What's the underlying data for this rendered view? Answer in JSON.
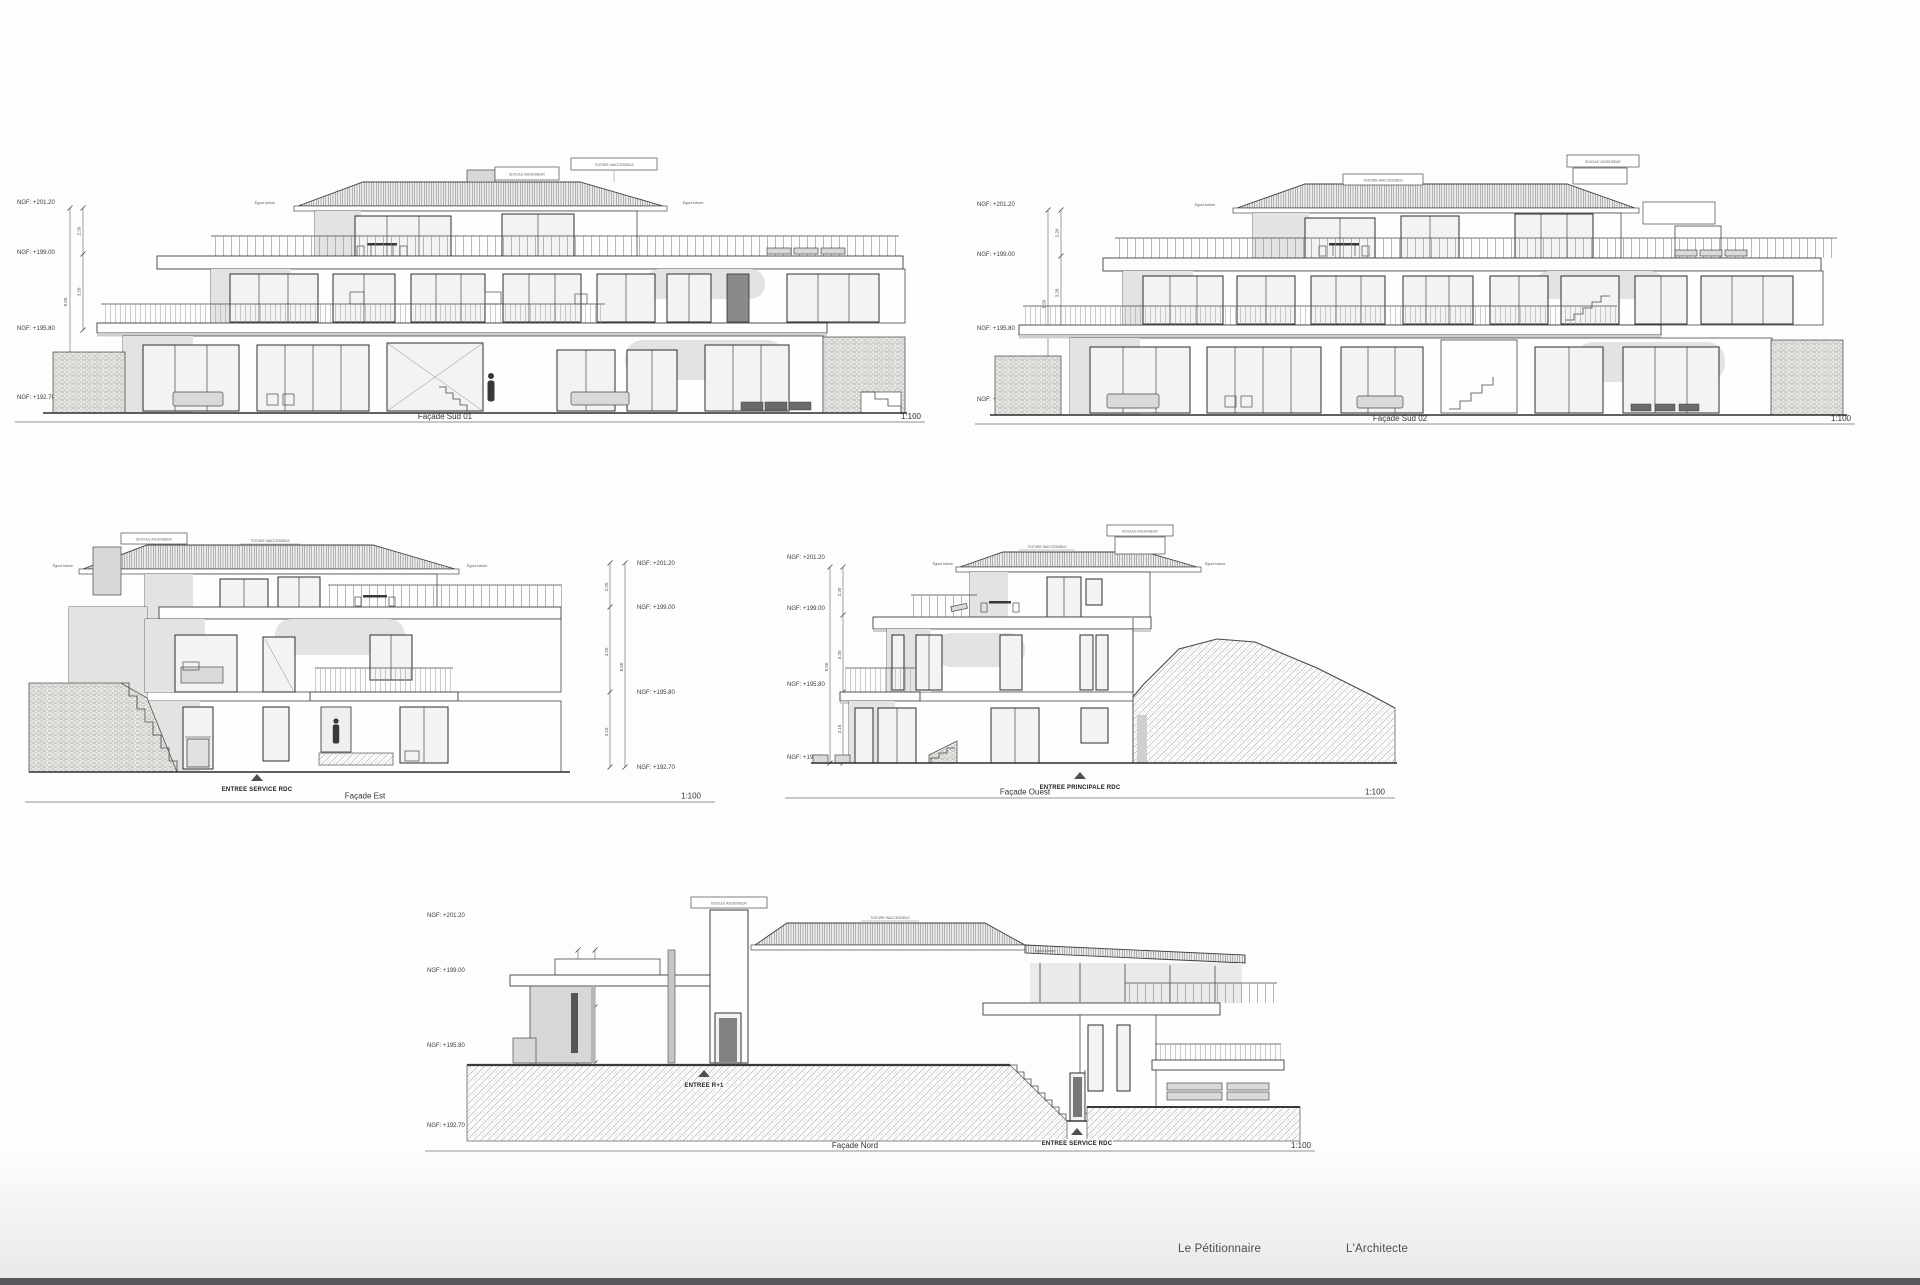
{
  "page": {
    "background": "#fdfdfd",
    "bottom_bar_color": "#56575a"
  },
  "common": {
    "scale_label": "1:100",
    "ngf": [
      "NGF: +201.20",
      "NGF: +199.00",
      "NGF: +195.80",
      "NGF: +192.70"
    ],
    "dims": {
      "d220": "2.20",
      "d320": "3.20",
      "d310": "3.10",
      "d850": "8.50",
      "d345": "3.45"
    },
    "annotations": {
      "edicule": "EDICULE ASCENSEUR",
      "toiture": "TOITURE INACCESSIBLE",
      "egout": "Égout toiture"
    },
    "entries": {
      "service": "ENTREE SERVICE RDC",
      "principale": "ENTREE PRINCIPALE RDC",
      "r1": "ENTREE R+1"
    }
  },
  "drawings": {
    "sud01": {
      "title": "Façade Sud 01"
    },
    "sud02": {
      "title": "Façade Sud 02"
    },
    "est": {
      "title": "Façade Est"
    },
    "ouest": {
      "title": "Façade Ouest"
    },
    "nord": {
      "title": "Façade Nord"
    }
  },
  "footer": {
    "petitionnaire": "Le Pétitionnaire",
    "architecte": "L'Architecte"
  },
  "colors": {
    "line": "#3f3f3f",
    "wall_shade": "#e3e3e2",
    "slab_shadow": "#a9a9a8",
    "window_frame": "#2d2d2d",
    "stone_joint": "#9b9a96",
    "hatch_line": "#8b8b8b"
  }
}
